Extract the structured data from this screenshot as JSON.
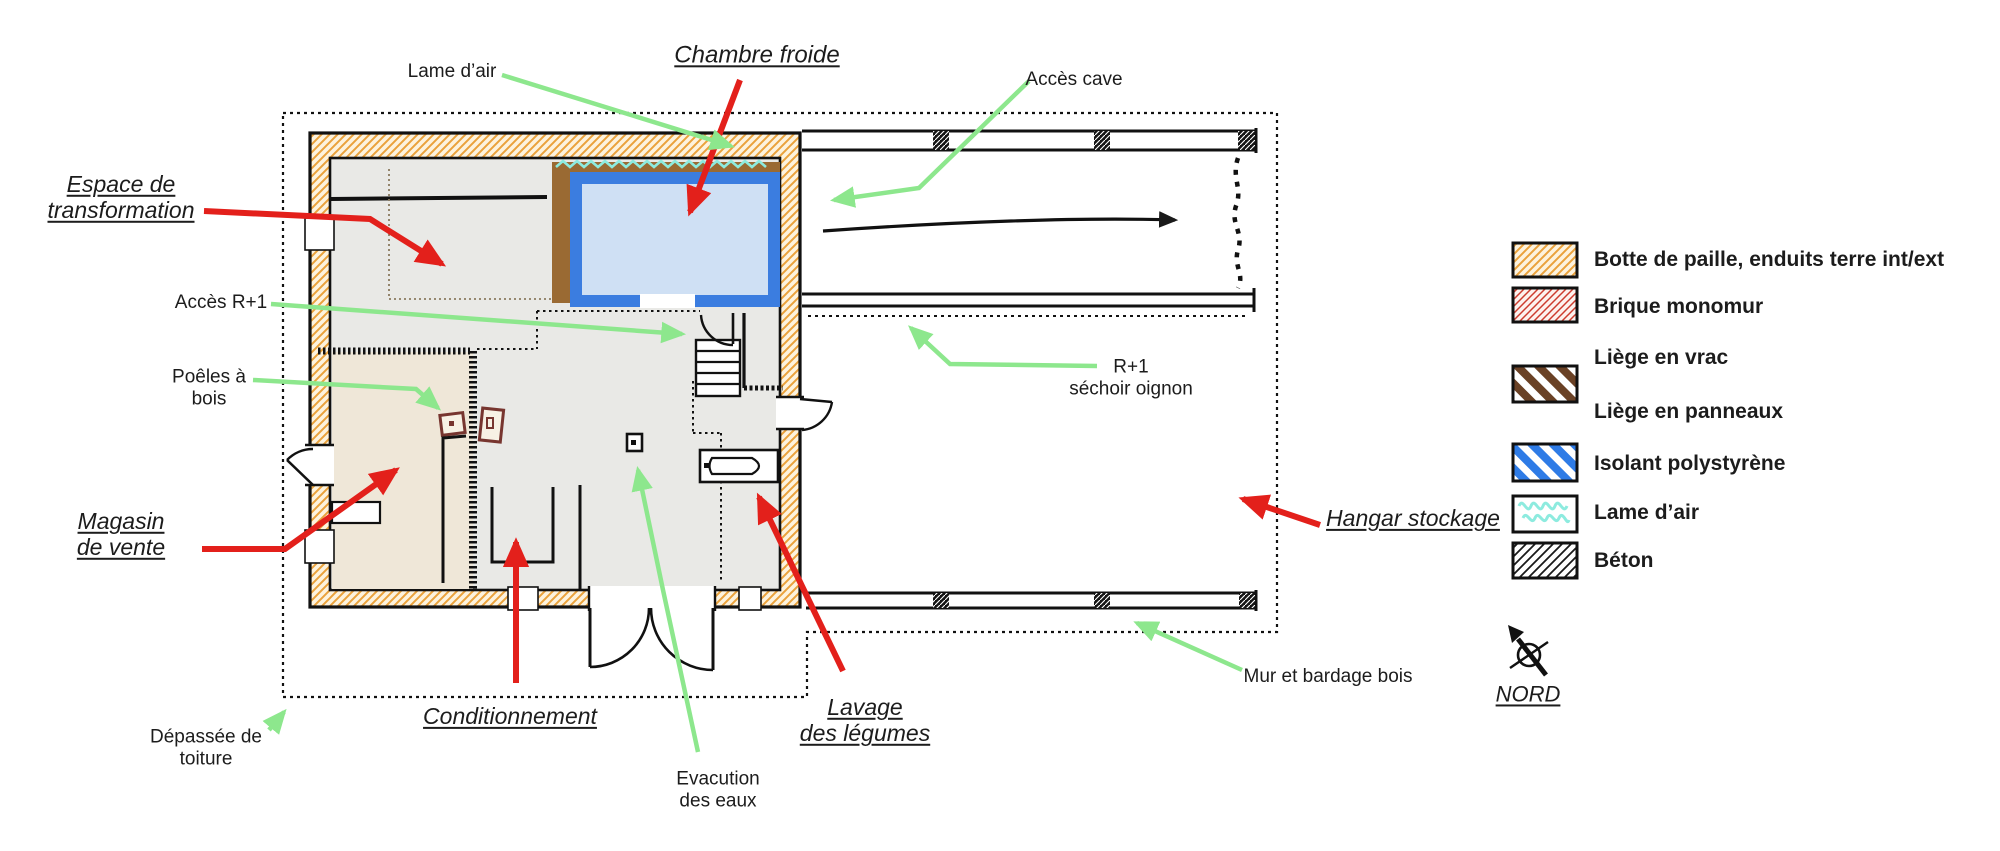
{
  "plan": {
    "labels": {
      "lame_air": "Lame d’air",
      "chambre_froide": "Chambre froide",
      "acces_cave": "Accès cave",
      "espace_transformation": "Espace de\ntransformation",
      "acces_r1": "Accès R+1",
      "poeles_bois": "Poêles à\nbois",
      "magasin_vente": "Magasin\nde vente",
      "depassee_toiture": "Dépassée de\ntoiture",
      "conditionnement": "Conditionnement",
      "evacuation_eaux": "Evacution\ndes eaux",
      "lavage_legumes": "Lavage\ndes légumes",
      "r1_sechoir": "R+1\nséchoir oignon",
      "hangar_stockage": "Hangar stockage",
      "mur_bardage": "Mur et bardage bois"
    }
  },
  "legend": {
    "items": [
      {
        "label": "Botte de paille, enduits terre int/ext",
        "color": "#eaa23c",
        "swatch": "straw-hatch"
      },
      {
        "label": "Brique monomur",
        "color": "#cd3c2e",
        "swatch": "brick-hatch"
      },
      {
        "label": "Liège en vrac",
        "color": "#6a4125",
        "swatch": "cork-stripes"
      },
      {
        "label": "Liège en panneaux",
        "color": "#6a4125",
        "swatch": "cork-stripes"
      },
      {
        "label": "Isolant polystyrène",
        "color": "#2e7be6",
        "swatch": "polystyrene-stripes"
      },
      {
        "label": "Lame d’air",
        "color": "#8debdf",
        "swatch": "air-squiggle"
      },
      {
        "label": "Béton",
        "color": "#1a1a1a",
        "swatch": "concrete-hatch"
      }
    ]
  },
  "compass": {
    "label": "NORD"
  },
  "colors": {
    "red_arrow": "#e3201b",
    "green_arrow": "#8de78d",
    "wall_straw": "#eaa23c",
    "cork_band": "#9a6a33",
    "polystyrene": "#3b7de0",
    "cold_room_fill": "#cfe0f4",
    "air_gap": "#8debdf",
    "floor_grey": "#e9e9e6",
    "floor_beige": "#efe7d8",
    "stove_outline": "#77352f"
  }
}
